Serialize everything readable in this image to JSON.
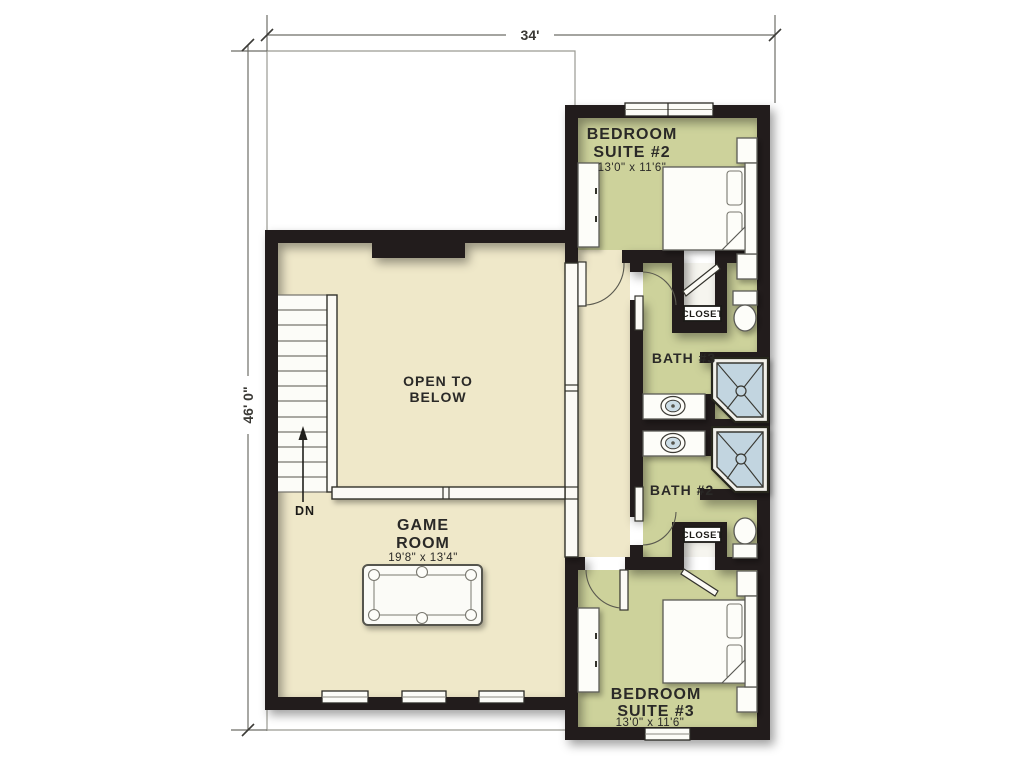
{
  "plan": {
    "title": "Second floor plan",
    "dimensions": {
      "width_label": "34'",
      "height_label": "46' 0\""
    }
  },
  "rooms": {
    "bedroom_suite_2": {
      "line1": "BEDROOM",
      "line2": "SUITE #2",
      "size": "13'0\" x 11'6\""
    },
    "bedroom_suite_3": {
      "line1": "BEDROOM",
      "line2": "SUITE #3",
      "size": "13'0\" x 11'6\""
    },
    "game_room": {
      "line1": "GAME",
      "line2": "ROOM",
      "size": "19'8\" x 13'4\""
    },
    "open_to_below": {
      "line1": "OPEN TO",
      "line2": "BELOW"
    },
    "bath_3": {
      "label": "BATH #3"
    },
    "bath_2": {
      "label": "BATH #2"
    },
    "closet_upper": {
      "label": "CLOSET"
    },
    "closet_lower": {
      "label": "CLOSET"
    },
    "stairs": {
      "label": "DN"
    }
  },
  "colors": {
    "wall": "#201f1c",
    "floor_main": "#efe8c9",
    "floor_suite": "#cdd29b",
    "shower": "#c2d5e0",
    "outline": "#9a9a92",
    "text": "#2a2927",
    "background": "#ffffff"
  }
}
